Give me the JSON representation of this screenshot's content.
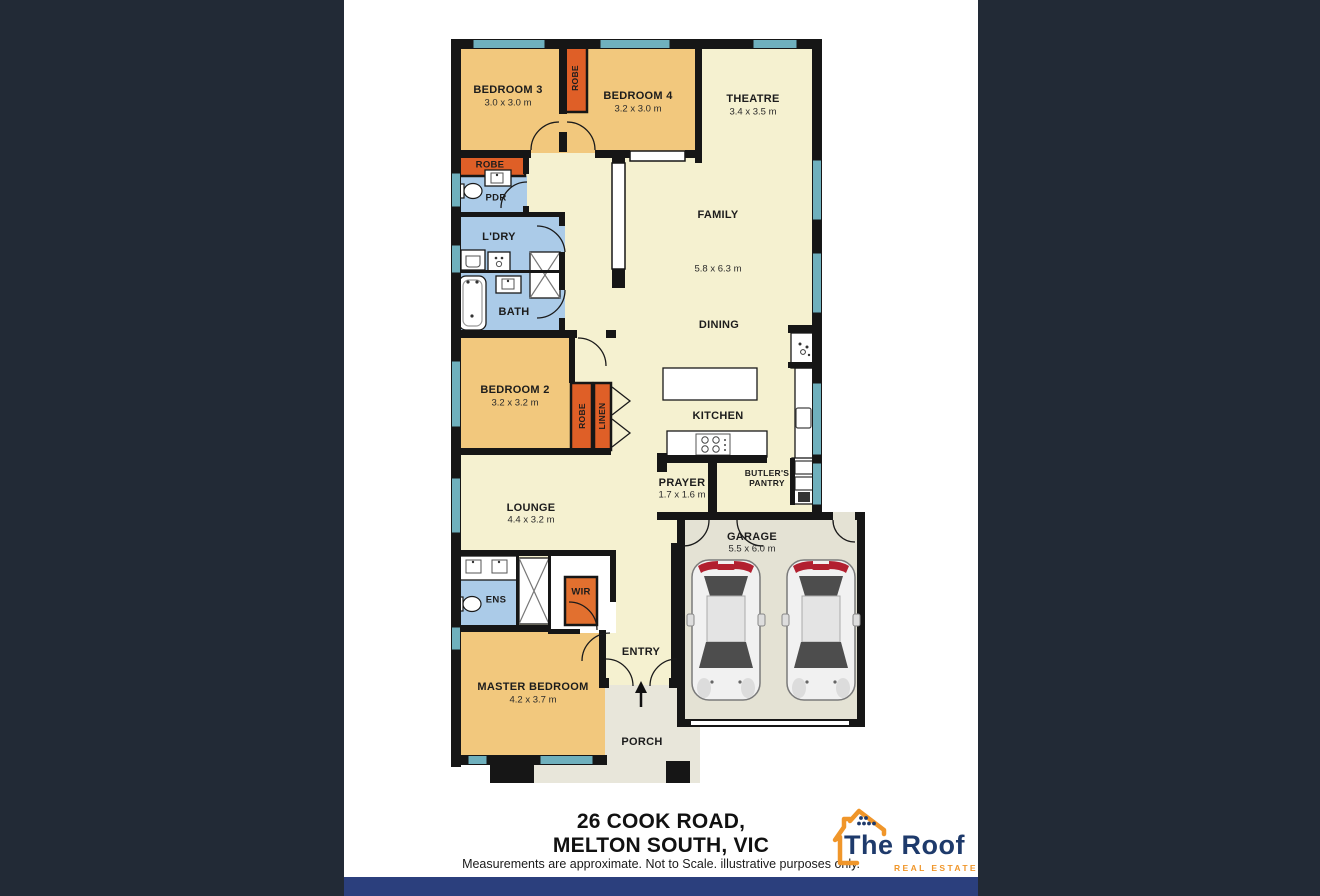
{
  "document": {
    "type": "real-estate-floor-plan"
  },
  "plan": {
    "rooms": {
      "bedroom3": {
        "name": "BEDROOM 3",
        "dims": "3.0 x 3.0 m"
      },
      "bedroom4": {
        "name": "BEDROOM 4",
        "dims": "3.2 x 3.0 m"
      },
      "theatre": {
        "name": "THEATRE",
        "dims": "3.4 x 3.5 m"
      },
      "family": {
        "name": "FAMILY",
        "dims": "5.8 x 6.3 m"
      },
      "dining": {
        "name": "DINING"
      },
      "kitchen": {
        "name": "KITCHEN"
      },
      "bedroom2": {
        "name": "BEDROOM 2",
        "dims": "3.2 x 3.2 m"
      },
      "prayer": {
        "name": "PRAYER",
        "dims": "1.7 x 1.6 m"
      },
      "butlers_pantry": {
        "name": "BUTLER'S PANTRY"
      },
      "lounge": {
        "name": "LOUNGE",
        "dims": "4.4 x 3.2 m"
      },
      "garage": {
        "name": "GARAGE",
        "dims": "5.5 x 6.0 m"
      },
      "master_bedroom": {
        "name": "MASTER BEDROOM",
        "dims": "4.2 x 3.7 m"
      },
      "entry": {
        "name": "ENTRY"
      },
      "porch": {
        "name": "PORCH"
      },
      "ens": {
        "name": "ENS"
      },
      "wir": {
        "name": "WIR"
      },
      "pdr": {
        "name": "PDR"
      },
      "laundry": {
        "name": "L'DRY"
      },
      "bath": {
        "name": "BATH"
      },
      "robe_bed3": {
        "name": "ROBE"
      },
      "robe_hall": {
        "name": "ROBE"
      },
      "robe_bed2": {
        "name": "ROBE"
      },
      "linen": {
        "name": "LINEN"
      }
    },
    "fixtures": [
      "toilet",
      "basin",
      "bathtub",
      "shower",
      "laundry-tub",
      "washing-machine",
      "cooktop",
      "kitchen-island",
      "sink",
      "fridge",
      "oven-stack",
      "car",
      "car",
      "entry-arrow"
    ]
  },
  "footer": {
    "address_line1": "26 COOK ROAD,",
    "address_line2": "MELTON SOUTH, VIC",
    "disclaimer": "Measurements are approximate. Not to Scale. illustrative purposes only."
  },
  "logo": {
    "name": "The Roof",
    "tagline": "REAL ESTATE"
  },
  "colors": {
    "sidebar": "#222a36",
    "footer_bar": "#2b3f7d",
    "floor_cream": "#f5f1d0",
    "bedroom_tan": "#f2c87d",
    "closet_orange": "#df5f27",
    "wet_area_blue": "#abcbe8",
    "window_teal": "#6fb0bd",
    "garage_grey": "#e4e2d4",
    "porch_grey": "#e8e6da",
    "wall_black": "#161616",
    "logo_navy": "#1e3a6b",
    "logo_orange": "#f0962a",
    "car_red": "#b22030"
  }
}
